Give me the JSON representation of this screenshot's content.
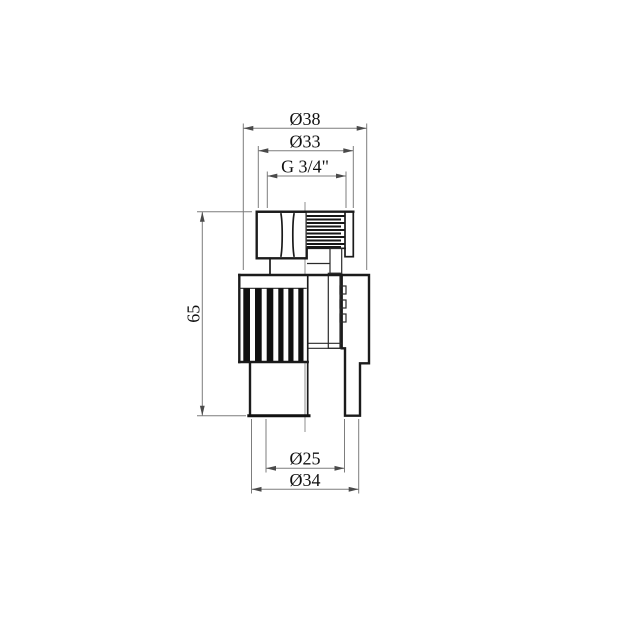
{
  "drawing": {
    "kind": "technical-dimension-drawing",
    "background_color": "#ffffff",
    "outline_color": "#1b1b1b",
    "dimension_line_color": "#7d7d7d",
    "text_color": "#101010",
    "dimensions": {
      "d38": {
        "label": "Ø38"
      },
      "d33": {
        "label": "Ø33"
      },
      "g34": {
        "label": "G 3/4\""
      },
      "h65": {
        "label": "65"
      },
      "d25": {
        "label": "Ø25"
      },
      "d34": {
        "label": "Ø34"
      }
    }
  }
}
